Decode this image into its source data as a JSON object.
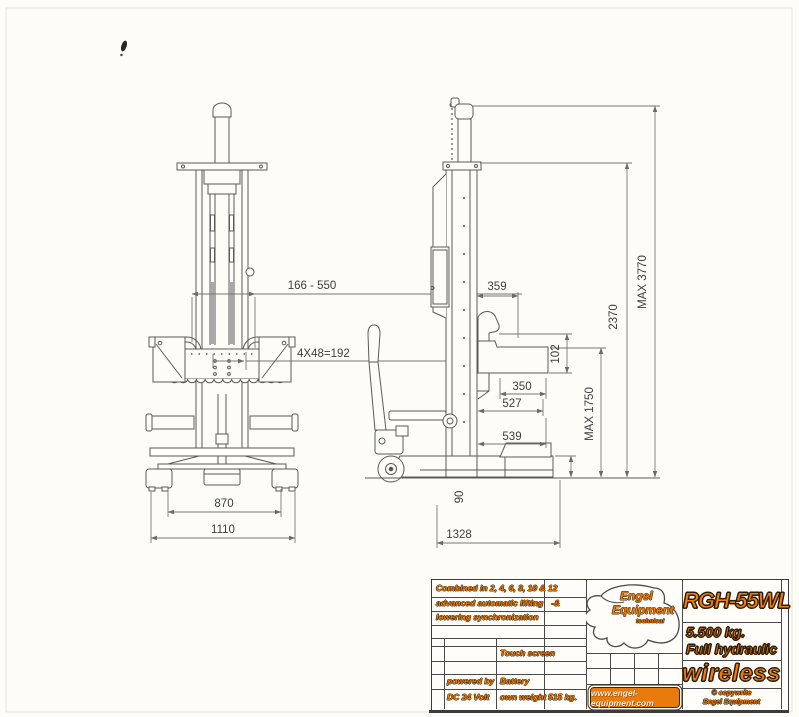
{
  "drawing": {
    "front": {
      "dim_width_range": "166 - 550",
      "dim_holes": "4X48=192",
      "dim_inner_base": "870",
      "dim_outer_base": "1110"
    },
    "side": {
      "d359": "359",
      "d102": "102",
      "d350": "350",
      "d527": "527",
      "d539": "539",
      "max_fork": "MAX 1750",
      "d90": "90",
      "base_length": "1328",
      "d2370": "2370",
      "max_height": "MAX 3770"
    }
  },
  "title_block": {
    "notes": {
      "line1": "Combined in 2, 4, 6, 8, 10 & 12",
      "line2": "advanced automatic lifting",
      "suffix": "-&",
      "line3": "lowering synchronization"
    },
    "specs": {
      "touch": "Touch screen",
      "powered_by": "powered by",
      "voltage": "DC 24 Volt",
      "battery": "Battery",
      "weight_label": "own weight",
      "weight_value": "515 kg."
    },
    "brand": {
      "line1": "Engel",
      "line2": "Equipment",
      "tagline": "technical",
      "website": "www.engel-equipment.com"
    },
    "product": {
      "model": "RGH-55WL",
      "capacity": "5.500 kg.",
      "feature": "Full hydraulic",
      "wireless": "wireless",
      "copy1": "© copywrite",
      "copy2": "Engel Equipment"
    }
  },
  "colors": {
    "accent_orange": "#e87b0c",
    "line_gray": "#5a5a5a"
  }
}
